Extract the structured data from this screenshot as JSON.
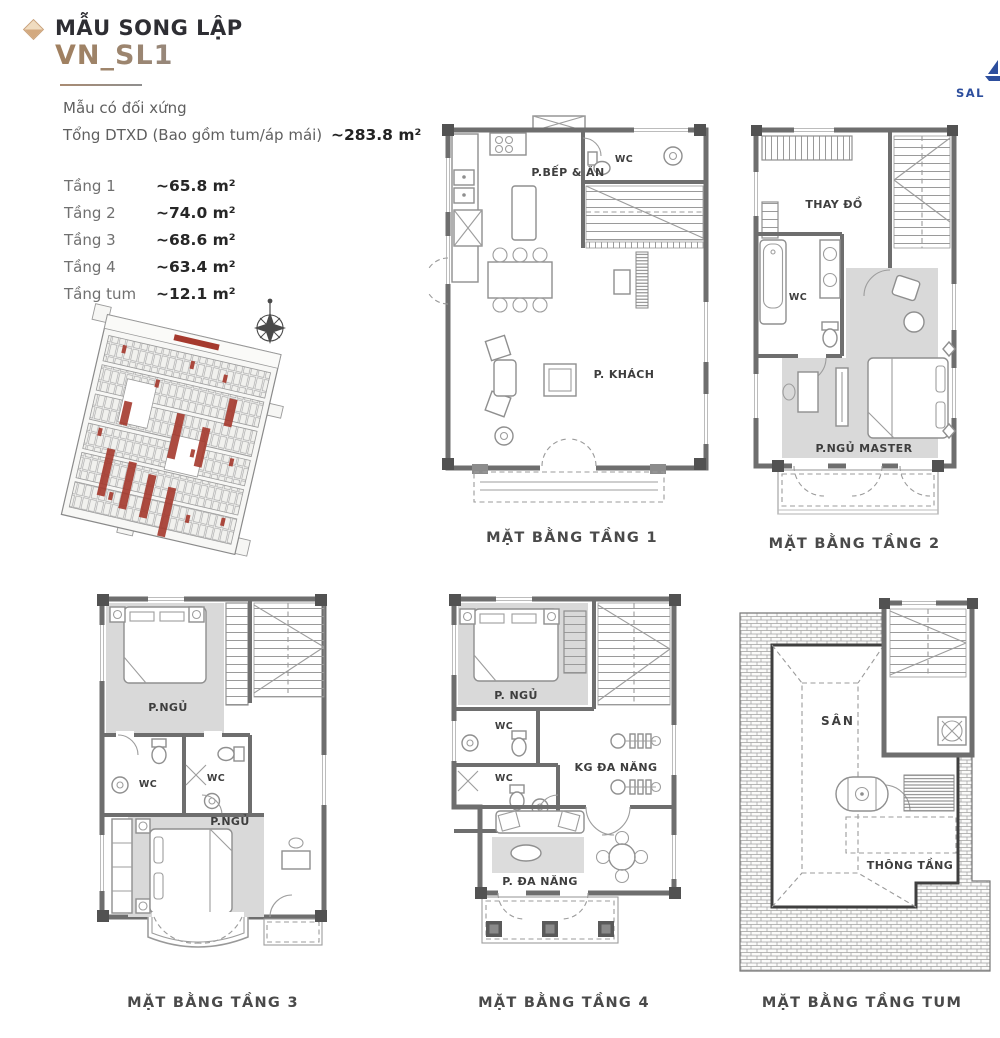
{
  "header": {
    "bullet_icon": "diamond-icon",
    "title": "MẪU SONG LẬP",
    "model_code": "VN_SL1",
    "note": "Mẫu có đối xứng",
    "total_label": "Tổng DTXD (Bao gồm tum/áp mái)",
    "total_value": "~283.8 m²"
  },
  "brand": {
    "partial_text": "SAL",
    "color": "#2d4e9d",
    "icon": "sail-logo-icon"
  },
  "area_table": {
    "rows": [
      {
        "label": "Tầng 1",
        "value": "~65.8 m²"
      },
      {
        "label": "Tầng 2",
        "value": "~74.0 m²"
      },
      {
        "label": "Tầng 3",
        "value": "~68.6 m²"
      },
      {
        "label": "Tầng 4",
        "value": "~63.4 m²"
      },
      {
        "label": "Tầng tum",
        "value": "~12.1 m²"
      }
    ]
  },
  "site_plan": {
    "compass_icon": "compass-rose-icon",
    "highlight_color": "#a5392d"
  },
  "plans": [
    {
      "caption": "MẶT BẰNG TẦNG 1",
      "rooms": [
        "P.BẾP & ĂN",
        "WC",
        "P. KHÁCH"
      ]
    },
    {
      "caption": "MẶT BẰNG TẦNG 2",
      "rooms": [
        "THAY ĐỒ",
        "WC",
        "P.NGỦ MASTER"
      ]
    },
    {
      "caption": "MẶT BẰNG TẦNG 3",
      "rooms": [
        "P.NGỦ",
        "WC",
        "WC",
        "P.NGỦ"
      ]
    },
    {
      "caption": "MẶT BẰNG TẦNG 4",
      "rooms": [
        "P. NGỦ",
        "WC",
        "WC",
        "KG ĐA NĂNG",
        "P. ĐA NĂNG"
      ]
    },
    {
      "caption": "MẶT BẰNG TẦNG TUM",
      "rooms": [
        "SÂN",
        "THÔNG TẦNG"
      ]
    }
  ],
  "colors": {
    "accent_brown": "#a8876b",
    "wall_gray": "#6e6e6e",
    "room_shade": "#d9d9d9",
    "map_red": "#a5392d",
    "brand_blue": "#2d4e9d"
  }
}
